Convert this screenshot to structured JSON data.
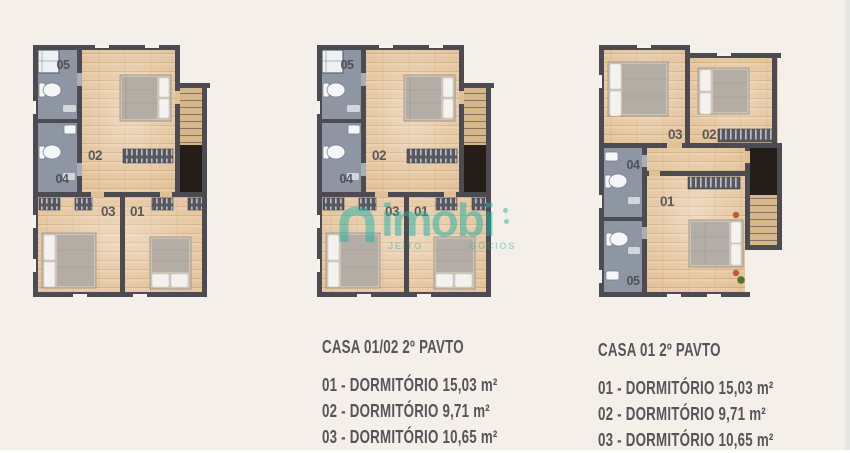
{
  "watermark": {
    "brand": "imobi",
    "tagline_left": "JEITO",
    "tagline_right": "GÓCIOS"
  },
  "room_labels": {
    "r01": "01",
    "r02": "02",
    "r03": "03",
    "r04": "04",
    "r05": "05"
  },
  "legends": {
    "left": {
      "title": "CASA 01/02 2º PAVTO",
      "items": [
        "01 - DORMITÓRIO 15,03 m²",
        "02 - DORMITÓRIO 9,71 m²",
        "03 - DORMITÓRIO 10,65 m²"
      ]
    },
    "right": {
      "title": "CASA 01 2º PAVTO",
      "items": [
        "01 - DORMITÓRIO 15,03 m²",
        "02 - DORMITÓRIO 9,71 m²",
        "03 - DORMITÓRIO 10,65 m²"
      ]
    }
  },
  "colors": {
    "background": "#f4efe8",
    "accent_teal": "#23b2a6",
    "wall": "#4b4b51",
    "wood_floor": "#e3c29a",
    "bathroom_floor": "#8d96a2",
    "stair_void": "#241d18",
    "legend_text": "#56555a"
  }
}
